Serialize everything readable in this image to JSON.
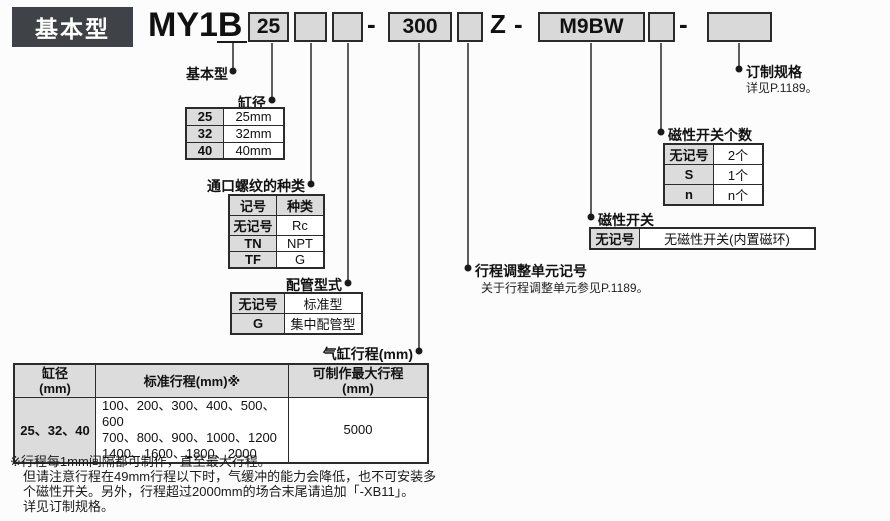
{
  "badge": "基本型",
  "model": {
    "series": "MY1B",
    "bore_value": "25",
    "stroke_value": "300",
    "suffix_z": "Z",
    "switch_value": "M9BW",
    "dash": "-"
  },
  "callouts": {
    "basic": {
      "label": "基本型"
    },
    "bore": {
      "label": "缸径"
    },
    "port": {
      "label": "通口螺纹的种类"
    },
    "piping": {
      "label": "配管型式"
    },
    "stroke": {
      "label": "气缸行程(mm)"
    },
    "adjuster": {
      "label": "行程调整单元记号",
      "note": "关于行程调整单元参见P.1189。"
    },
    "autoswitch": {
      "label": "磁性开关"
    },
    "switch_count": {
      "label": "磁性开关个数"
    },
    "made_to_order": {
      "label": "订制规格",
      "note": "详见P.1189。"
    }
  },
  "bore_table": {
    "rows": [
      [
        "25",
        "25mm"
      ],
      [
        "32",
        "32mm"
      ],
      [
        "40",
        "40mm"
      ]
    ]
  },
  "port_table": {
    "header": [
      "记号",
      "种类"
    ],
    "rows": [
      [
        "无记号",
        "Rc"
      ],
      [
        "TN",
        "NPT"
      ],
      [
        "TF",
        "G"
      ]
    ]
  },
  "piping_table": {
    "rows": [
      [
        "无记号",
        "标准型"
      ],
      [
        "G",
        "集中配管型"
      ]
    ]
  },
  "stroke_table": {
    "col_bore": "缸径\n(mm)",
    "col_std": "标准行程(mm)※",
    "col_max": "可制作最大行程\n(mm)",
    "row": {
      "bore": "25、32、40",
      "std_lines": [
        "100、200、300、400、500、600",
        "700、800、900、1000、1200",
        "1400、1600、1800、2000"
      ],
      "max": "5000"
    }
  },
  "autoswitch_table": {
    "rows": [
      [
        "无记号",
        "无磁性开关(内置磁环)"
      ]
    ]
  },
  "count_table": {
    "rows": [
      [
        "无记号",
        "2个"
      ],
      [
        "S",
        "1个"
      ],
      [
        "n",
        "n个"
      ]
    ]
  },
  "notes": [
    "※行程每1mm间隔都可制作，直至最大行程。",
    "但请注意行程在49mm行程以下时，气缓冲的能力会降低，也不可安装多",
    "个磁性开关。另外，行程超过2000mm的场合末尾请追加「-XB11」。",
    "详见订制规格。"
  ],
  "colors": {
    "box_fill": "#d9d9d9",
    "badge_bg": "#3f4347",
    "line": "#1a1a1a",
    "table_shade": "#dcdcdc"
  }
}
